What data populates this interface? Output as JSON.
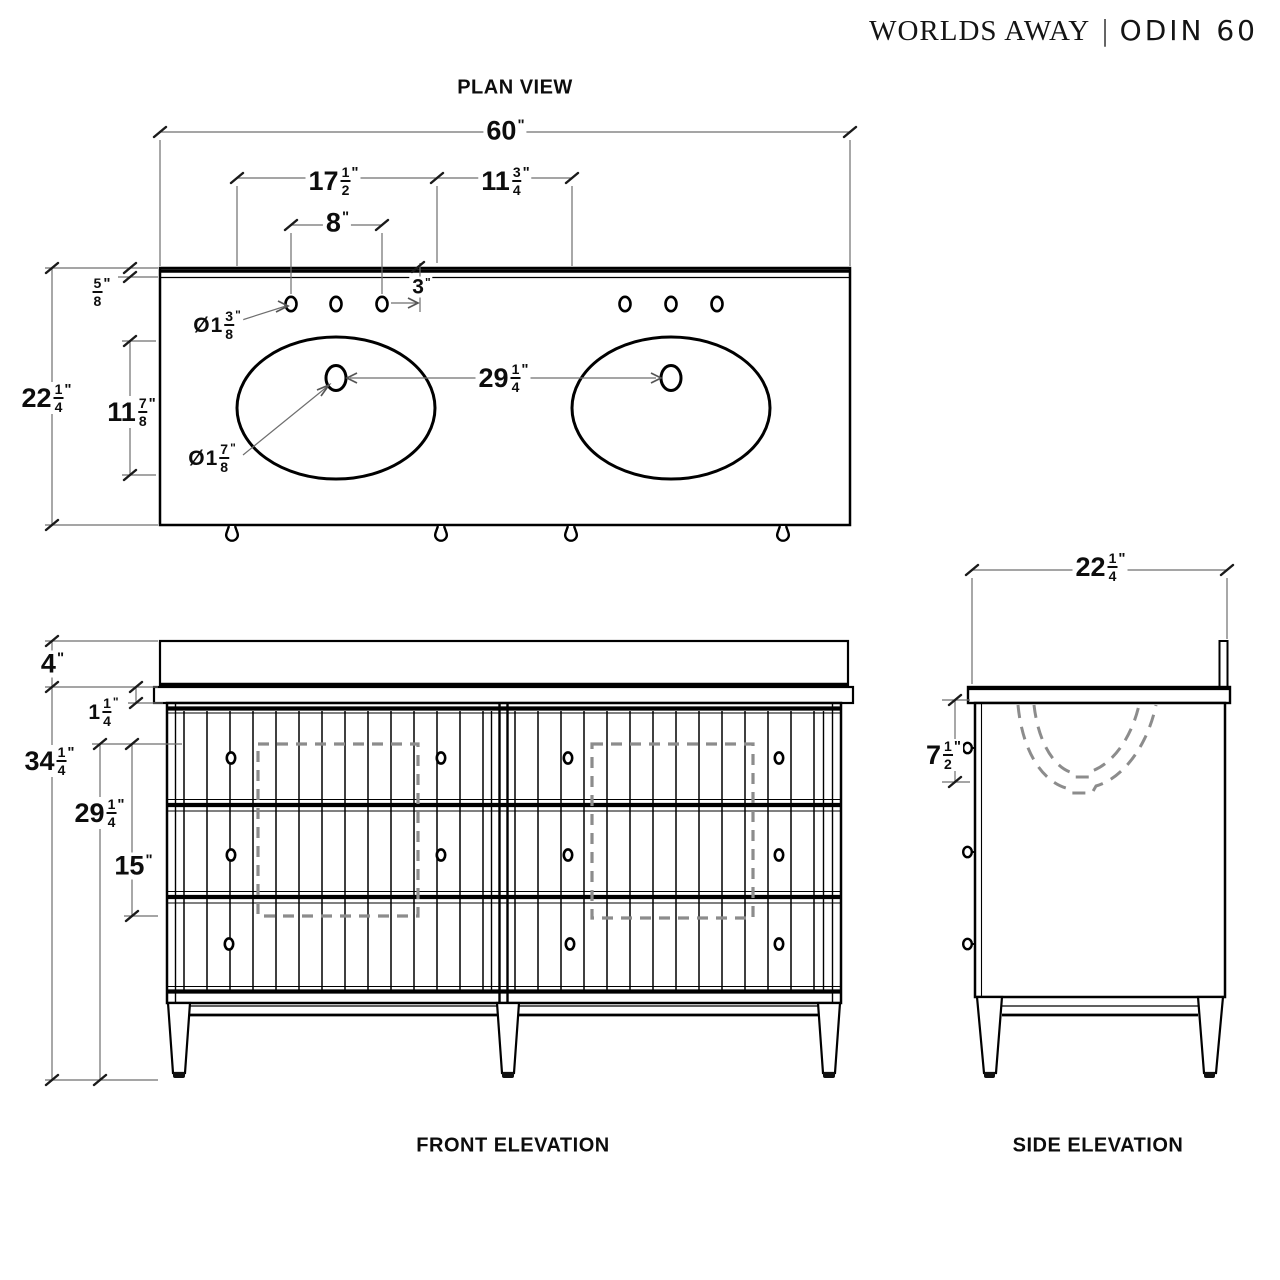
{
  "header": {
    "brand": "WORLDS AWAY",
    "separator": "|",
    "model": "ODIN 60"
  },
  "views": {
    "plan": {
      "label": "PLAN VIEW"
    },
    "front": {
      "label": "FRONT ELEVATION"
    },
    "side": {
      "label": "SIDE ELEVATION"
    }
  },
  "colors": {
    "ink": "#000000",
    "dim_line": "#6f6f6f",
    "hidden_dash": "#8c8c8c"
  },
  "dims": {
    "overall_width": {
      "whole": "60",
      "unit": "\""
    },
    "faucet_span_left": {
      "whole": "17",
      "num": "1",
      "den": "2",
      "unit": "\""
    },
    "faucet_span_right": {
      "whole": "11",
      "num": "3",
      "den": "4",
      "unit": "\""
    },
    "faucet_spread": {
      "whole": "8",
      "unit": "\""
    },
    "hole_setback": {
      "whole": "3",
      "unit": "\""
    },
    "backsplash_depth": {
      "num": "5",
      "den": "8",
      "unit": "\""
    },
    "counter_depth": {
      "whole": "22",
      "num": "1",
      "den": "4",
      "unit": "\""
    },
    "sink_setback": {
      "whole": "11",
      "num": "7",
      "den": "8",
      "unit": "\""
    },
    "faucet_hole_dia": {
      "pre": "Ø",
      "whole": "1",
      "num": "3",
      "den": "8",
      "unit": "\""
    },
    "drain_hole_dia": {
      "pre": "Ø",
      "whole": "1",
      "num": "7",
      "den": "8",
      "unit": "\""
    },
    "sink_spacing": {
      "whole": "29",
      "num": "1",
      "den": "4",
      "unit": "\""
    },
    "backsplash_height": {
      "whole": "4",
      "unit": "\""
    },
    "counter_thickness": {
      "whole": "1",
      "num": "1",
      "den": "4",
      "unit": "\""
    },
    "overall_height": {
      "whole": "34",
      "num": "1",
      "den": "4",
      "unit": "\""
    },
    "clearance_height": {
      "whole": "29",
      "num": "1",
      "den": "4",
      "unit": "\""
    },
    "cutout_height": {
      "whole": "15",
      "unit": "\""
    },
    "side_depth": {
      "whole": "22",
      "num": "1",
      "den": "4",
      "unit": "\""
    },
    "bowl_depth": {
      "whole": "7",
      "num": "1",
      "den": "2",
      "unit": "\""
    }
  }
}
